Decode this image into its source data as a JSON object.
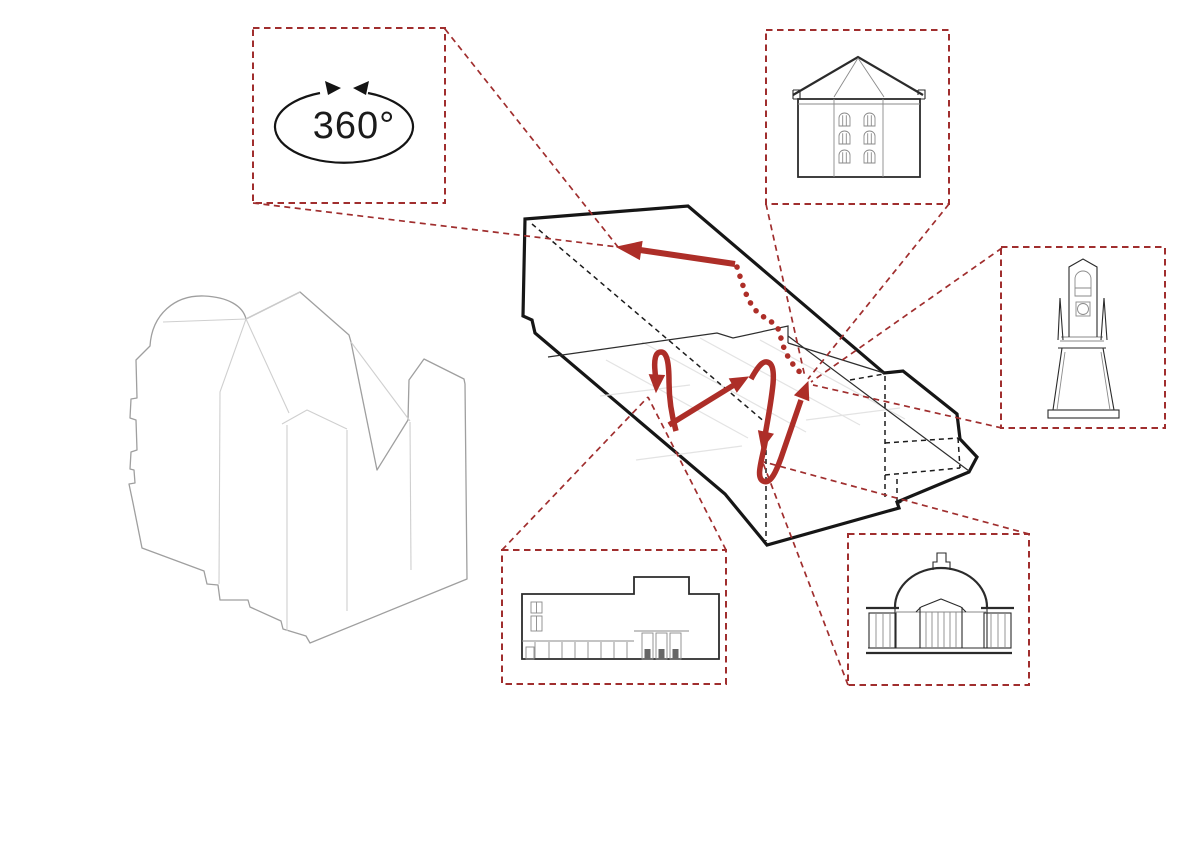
{
  "diagram": {
    "kind": "architectural-circulation-axonometric-diagram",
    "rotation_label": "360°",
    "colors": {
      "callout_red": "#a02e2e",
      "route_red": "#ad2e28",
      "outline_black": "#161616",
      "ghost_gray": "#9f9f9f",
      "floor_grid_gray": "#e3e3e3",
      "background": "#ffffff"
    },
    "callouts": [
      {
        "id": "rotation-360",
        "label": "360°",
        "icon": "rotation-360-icon"
      },
      {
        "id": "hip-roof-building",
        "icon": "hip-roof-building-elevation-icon"
      },
      {
        "id": "tower-monument",
        "icon": "tapered-tower-elevation-icon"
      },
      {
        "id": "colonnade-hall",
        "icon": "colonnade-hall-elevation-icon"
      },
      {
        "id": "domed-pavilion",
        "icon": "domed-pavilion-elevation-icon"
      }
    ]
  }
}
